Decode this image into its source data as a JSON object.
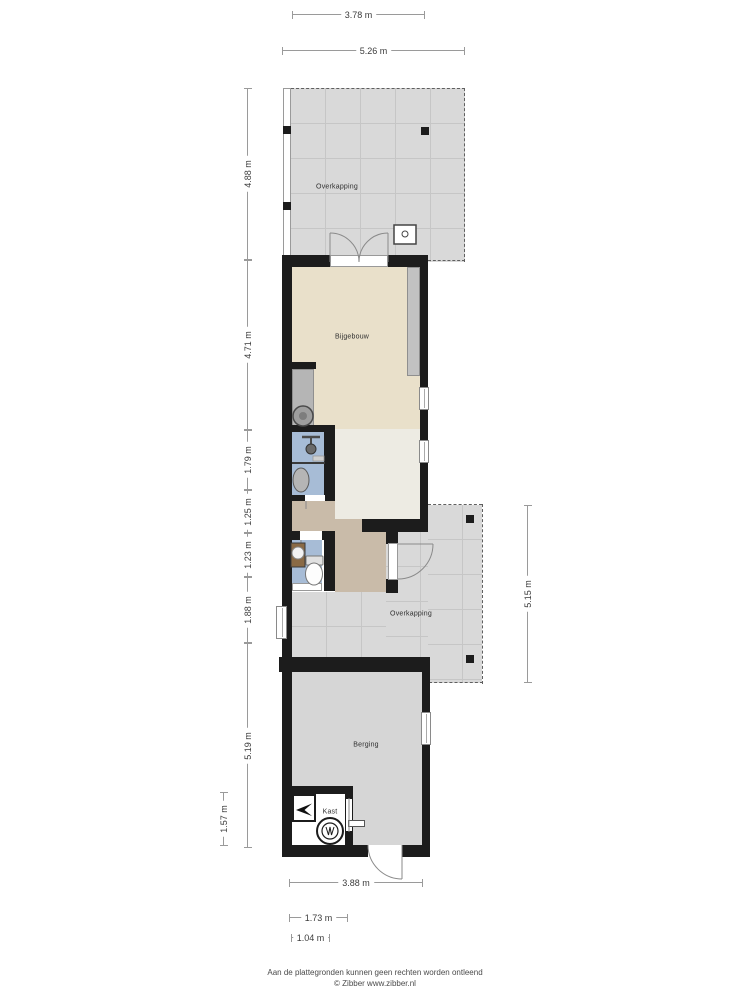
{
  "rooms": {
    "overkapping_top": "Overkapping",
    "bijgebouw": "Bijgebouw",
    "overkapping_mid": "Overkapping",
    "berging": "Berging",
    "kast": "Kast"
  },
  "dimensions": {
    "top": [
      "3.78 m",
      "5.26 m"
    ],
    "left": [
      "4.88 m",
      "4.71 m",
      "1.79 m",
      "1.25 m",
      "1.23 m",
      "1.88 m",
      "5.19 m"
    ],
    "left_outer": "1.57 m",
    "right": "5.15 m",
    "bottom": [
      "3.88 m",
      "1.73 m",
      "1.04 m"
    ]
  },
  "footer": {
    "line1": "Aan de plattegronden kunnen geen rechten worden ontleend",
    "line2": "© Zibber www.zibber.nl"
  },
  "colors": {
    "page": "#ffffff",
    "wall": "#1c1c1c",
    "tile": "#d9d9d9",
    "tile_line": "#c6c6c6",
    "beige": "#e9e0ca",
    "offwhite": "#edebe3",
    "tan": "#c9bba9",
    "blue": "#a7bcd6",
    "berging_gray": "#d6d6d6",
    "counter": "#c2c2c2",
    "dim": "#9a9a9a",
    "text": "#2f2f2f"
  }
}
